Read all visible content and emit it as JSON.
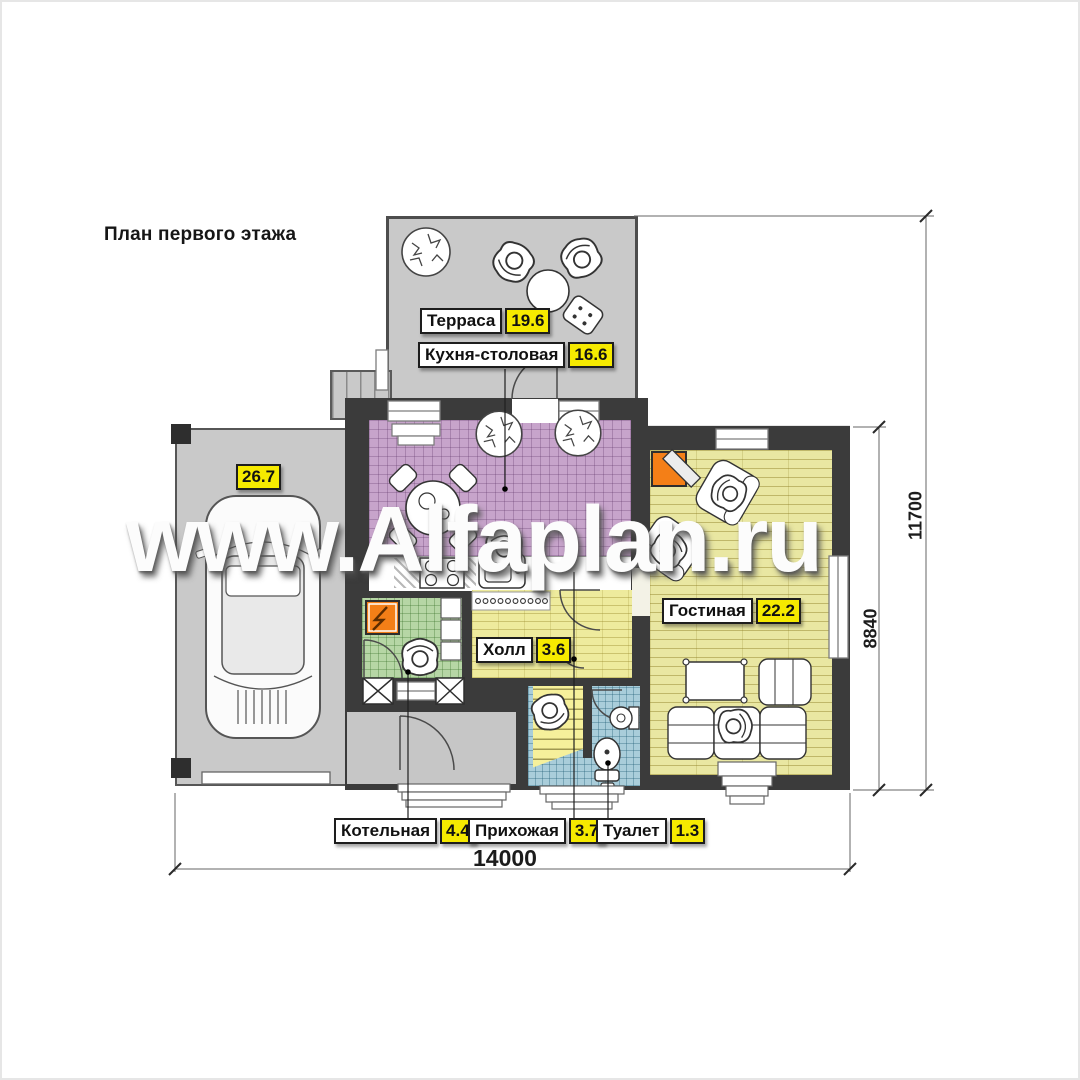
{
  "title": "План первого этажа",
  "watermark": "www.Alfaplan.ru",
  "rooms": {
    "terrace": {
      "label": "Терраса",
      "area": "19.6"
    },
    "kitchen": {
      "label": "Кухня-столовая",
      "area": "16.6"
    },
    "garage": {
      "area": "26.7"
    },
    "living": {
      "label": "Гостиная",
      "area": "22.2"
    },
    "hall": {
      "label": "Холл",
      "area": "3.6"
    },
    "boiler": {
      "label": "Котельная",
      "area": "4.4"
    },
    "entry": {
      "label": "Прихожая",
      "area": "3.7"
    },
    "wc": {
      "label": "Туалет",
      "area": "1.3"
    }
  },
  "dimensions": {
    "width": "14000",
    "height_main": "8840",
    "height_total": "11700"
  },
  "colors": {
    "wall": "#3b3b3b",
    "terrace_floor": "#c9c9c9",
    "kitchen_tile": "#c7a4cb",
    "living_floor": "#e9e7a2",
    "hall_floor": "#eeeb9d",
    "boiler_tile": "#b6d6a5",
    "wc_tile": "#a9cdda",
    "stairs": "#f6f09b",
    "label_value_bg": "#f6ea00",
    "fireplace": "#f47f17",
    "electric_panel": "#f47f17"
  }
}
